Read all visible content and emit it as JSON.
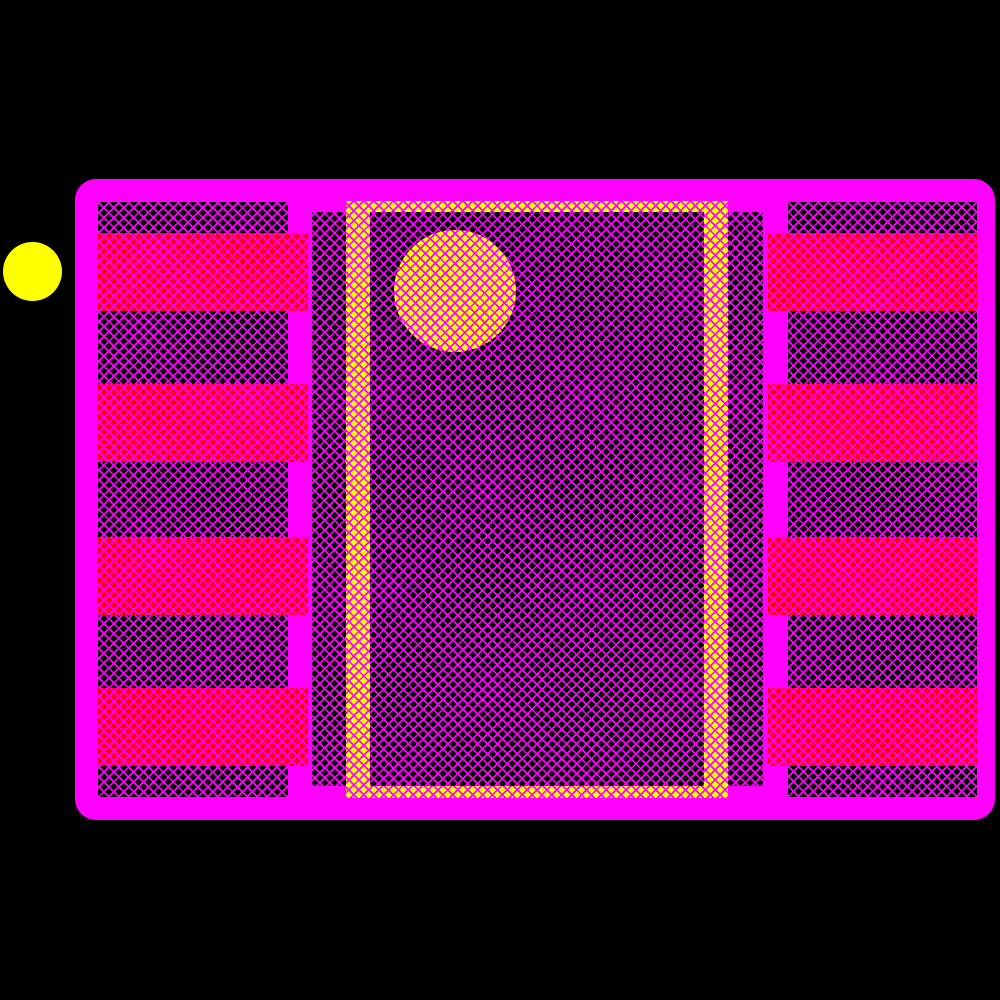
{
  "scene": {
    "description": "PCB footprint land pattern preview (8-pad dual-row package with central thermal paste frame and pin-1 markers)",
    "background_color": "#000000",
    "colors": {
      "outline_magenta": "#FF00FF",
      "pad_red": "#FF0010",
      "body_black": "#000000",
      "paste_yellow": "#FFFF00",
      "pin1_yellow": "#FFFF00",
      "hatch_line": "#FF00FF"
    },
    "hatch": {
      "line_color": "#FF00FF",
      "line_width_px": 1.7,
      "period_px": 7
    },
    "pin1_dot": {
      "x": 3,
      "y": 242,
      "diameter": 59
    },
    "outline": {
      "x": 75,
      "y": 179,
      "w": 920,
      "h": 641,
      "corner_radius": 21
    },
    "regions": [
      {
        "name": "left-body-hatch",
        "shape": "rect",
        "fill": "dark",
        "x": 98,
        "y": 202,
        "w": 190,
        "h": 595
      },
      {
        "name": "right-body-hatch",
        "shape": "rect",
        "fill": "dark",
        "x": 788,
        "y": 202,
        "w": 189,
        "h": 595
      },
      {
        "name": "center-body-hatch",
        "shape": "rect",
        "fill": "dark",
        "x": 312,
        "y": 212,
        "w": 451,
        "h": 574
      },
      {
        "name": "paste-frame",
        "shape": "rect",
        "fill": "yellow",
        "x": 346,
        "y": 201,
        "w": 382,
        "h": 597
      },
      {
        "name": "paste-frame-interior",
        "shape": "rect",
        "fill": "dark",
        "x": 370,
        "y": 212,
        "w": 334,
        "h": 574
      },
      {
        "name": "pin1-marker-circle",
        "shape": "circle",
        "fill": "yellow",
        "x": 394,
        "y": 230,
        "w": 122,
        "h": 122
      }
    ],
    "pads": {
      "count_per_side": 4,
      "height": 78,
      "rows_y": [
        233,
        384,
        537,
        688
      ],
      "left_column": {
        "x": 98,
        "width": 210
      },
      "right_column": {
        "x": 768,
        "width": 209
      }
    }
  }
}
